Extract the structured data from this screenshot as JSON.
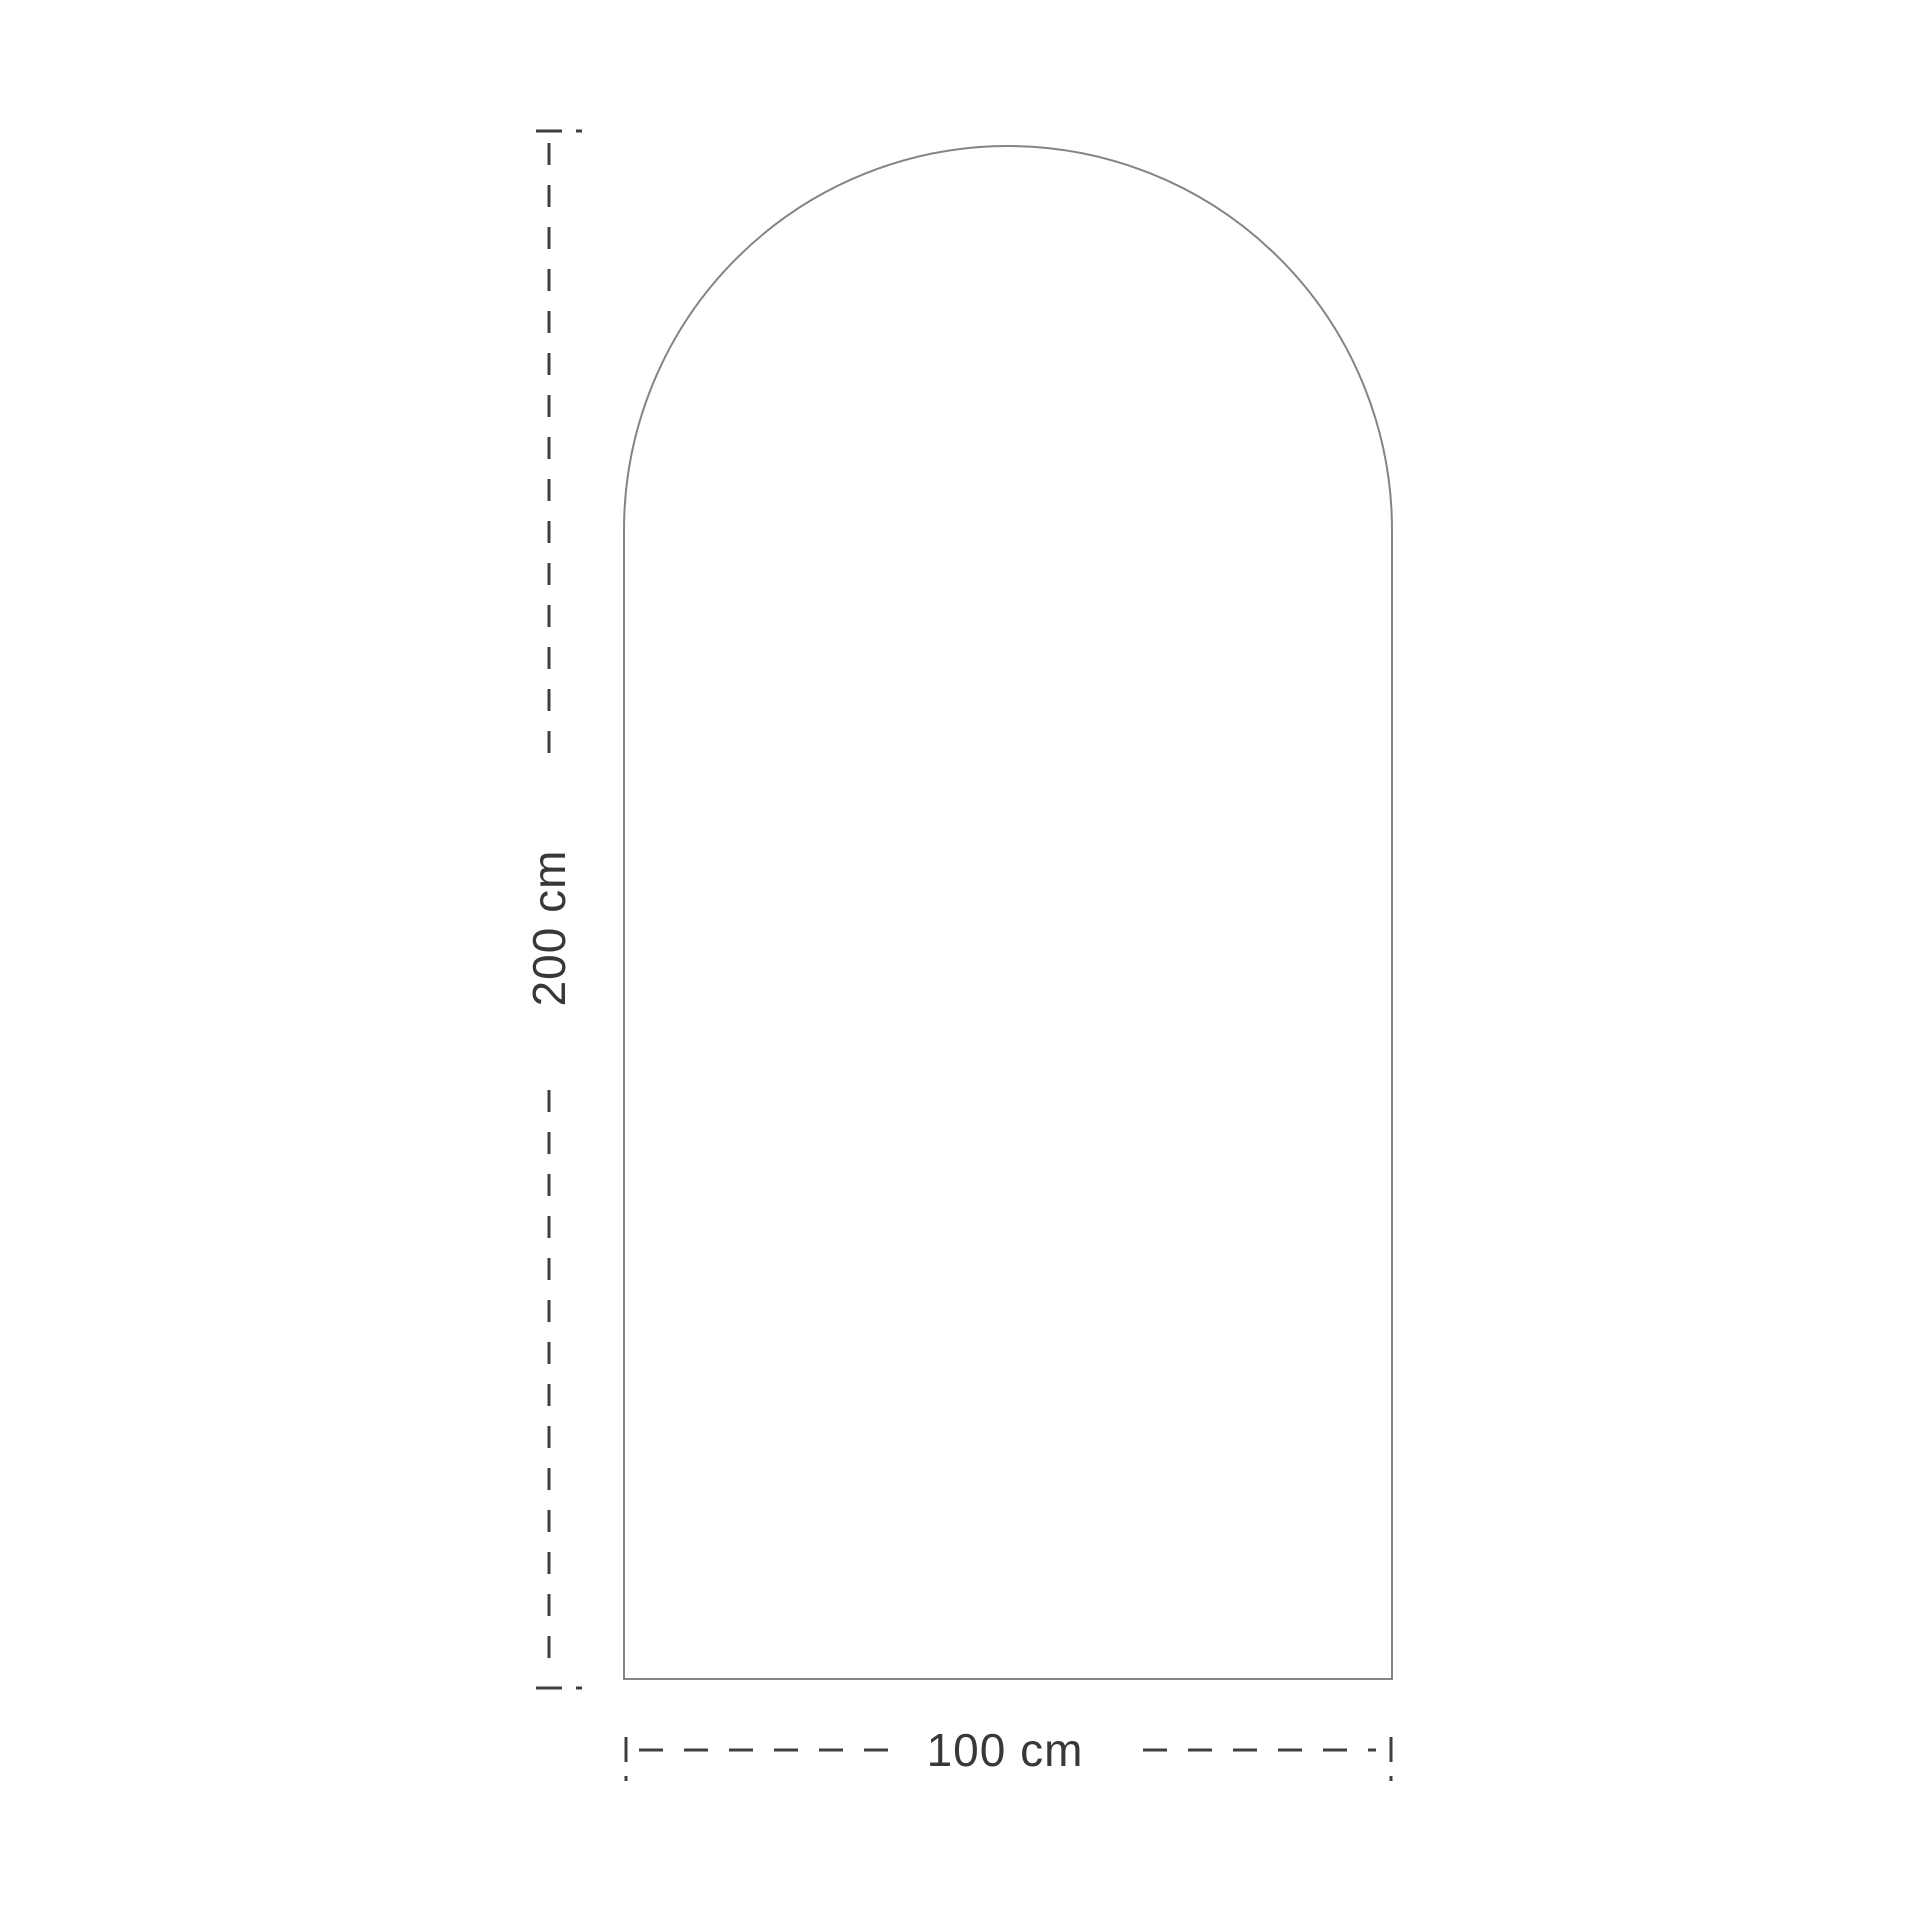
{
  "diagram": {
    "title": "arched panel dimension drawing",
    "dimensions": {
      "height": {
        "label": "200 cm",
        "value": 200,
        "unit": "cm"
      },
      "width": {
        "label": "100 cm",
        "value": 100,
        "unit": "cm"
      }
    },
    "colors": {
      "background": "#ffffff",
      "outline": "#848484",
      "dimension_line": "#3f3f3f",
      "label_text": "#383838"
    }
  }
}
